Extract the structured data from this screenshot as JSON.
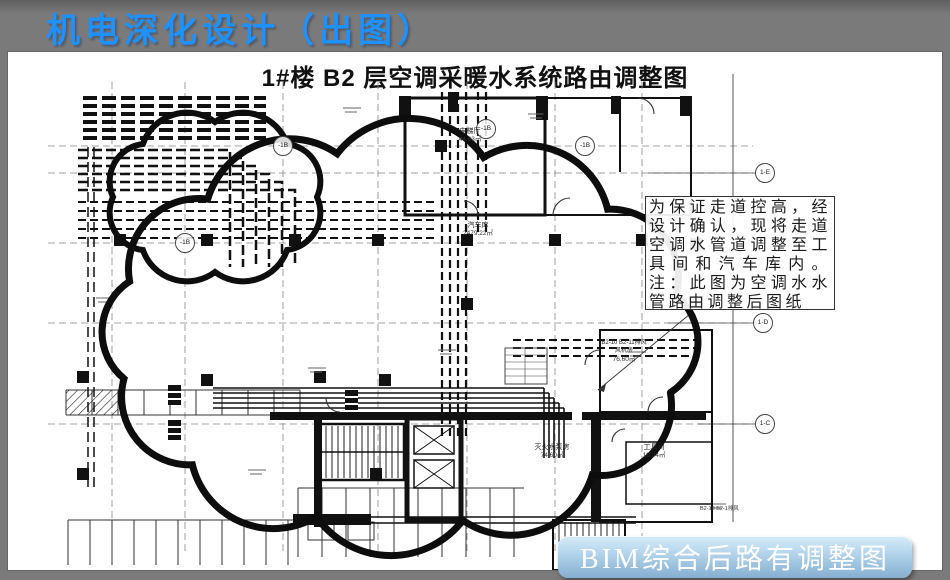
{
  "slide": {
    "title": "机电深化设计（出图）"
  },
  "drawing": {
    "title": "1#楼 B2 层空调采暖水系统路由调整图",
    "note": "为保证走道控高，经设计确认，现将走道空调水管道调整至工具间和汽车库内。注：此图为空调水水管路由调整后图纸",
    "grid_bubbles": [
      "-1B",
      "-1B",
      "-1B",
      "-1B",
      "1-E",
      "1-D",
      "1-C"
    ],
    "rooms": [
      {
        "name": "电梯厅",
        "area": "44.63㎡"
      },
      {
        "name": "汽车库",
        "area": "2479.22㎡"
      },
      {
        "name": "灭火水泵房",
        "area": "74.60㎡"
      },
      {
        "name": "工具间",
        "area": "19.04㎡"
      }
    ],
    "fan_room": {
      "line1": "B2-10 B2-11排风",
      "line2": "风机房",
      "area": "76.60㎡"
    },
    "small_label": "B2-18 B2-1排风"
  },
  "caption": {
    "text": "BIM综合后路有调整图"
  },
  "colors": {
    "title_blue": "#1e90ff",
    "slide_bg": "#7a7a7a",
    "badge_top": "#d6ebf8",
    "badge_bottom": "#86aed0",
    "badge_text": "#ffffff"
  }
}
